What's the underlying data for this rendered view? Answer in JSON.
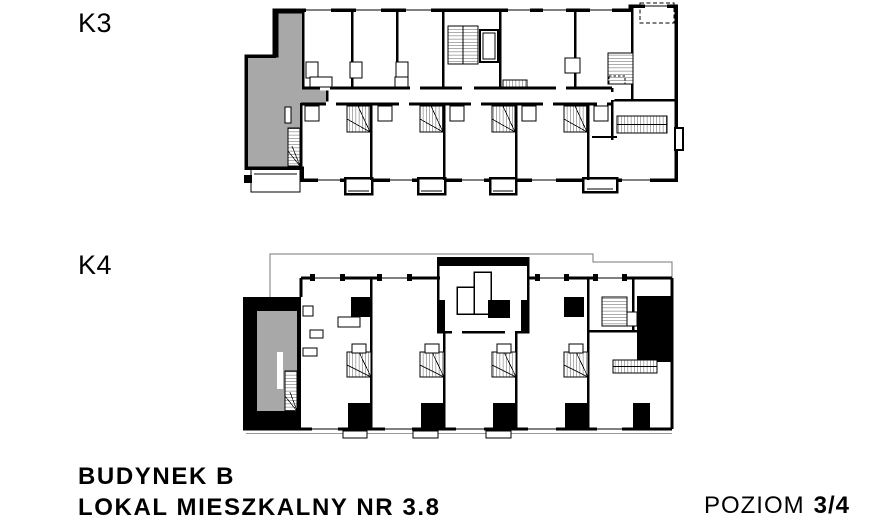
{
  "plans": {
    "k3": {
      "label": "K3"
    },
    "k4": {
      "label": "K4"
    }
  },
  "footer": {
    "building": "BUDYNEK B",
    "unit": "LOKAL MIESZKALNY NR 3.8",
    "level_label": "POZIOM",
    "level_value": "3/4"
  },
  "colors": {
    "highlight": "#a8a8a8",
    "wall": "#000000"
  }
}
